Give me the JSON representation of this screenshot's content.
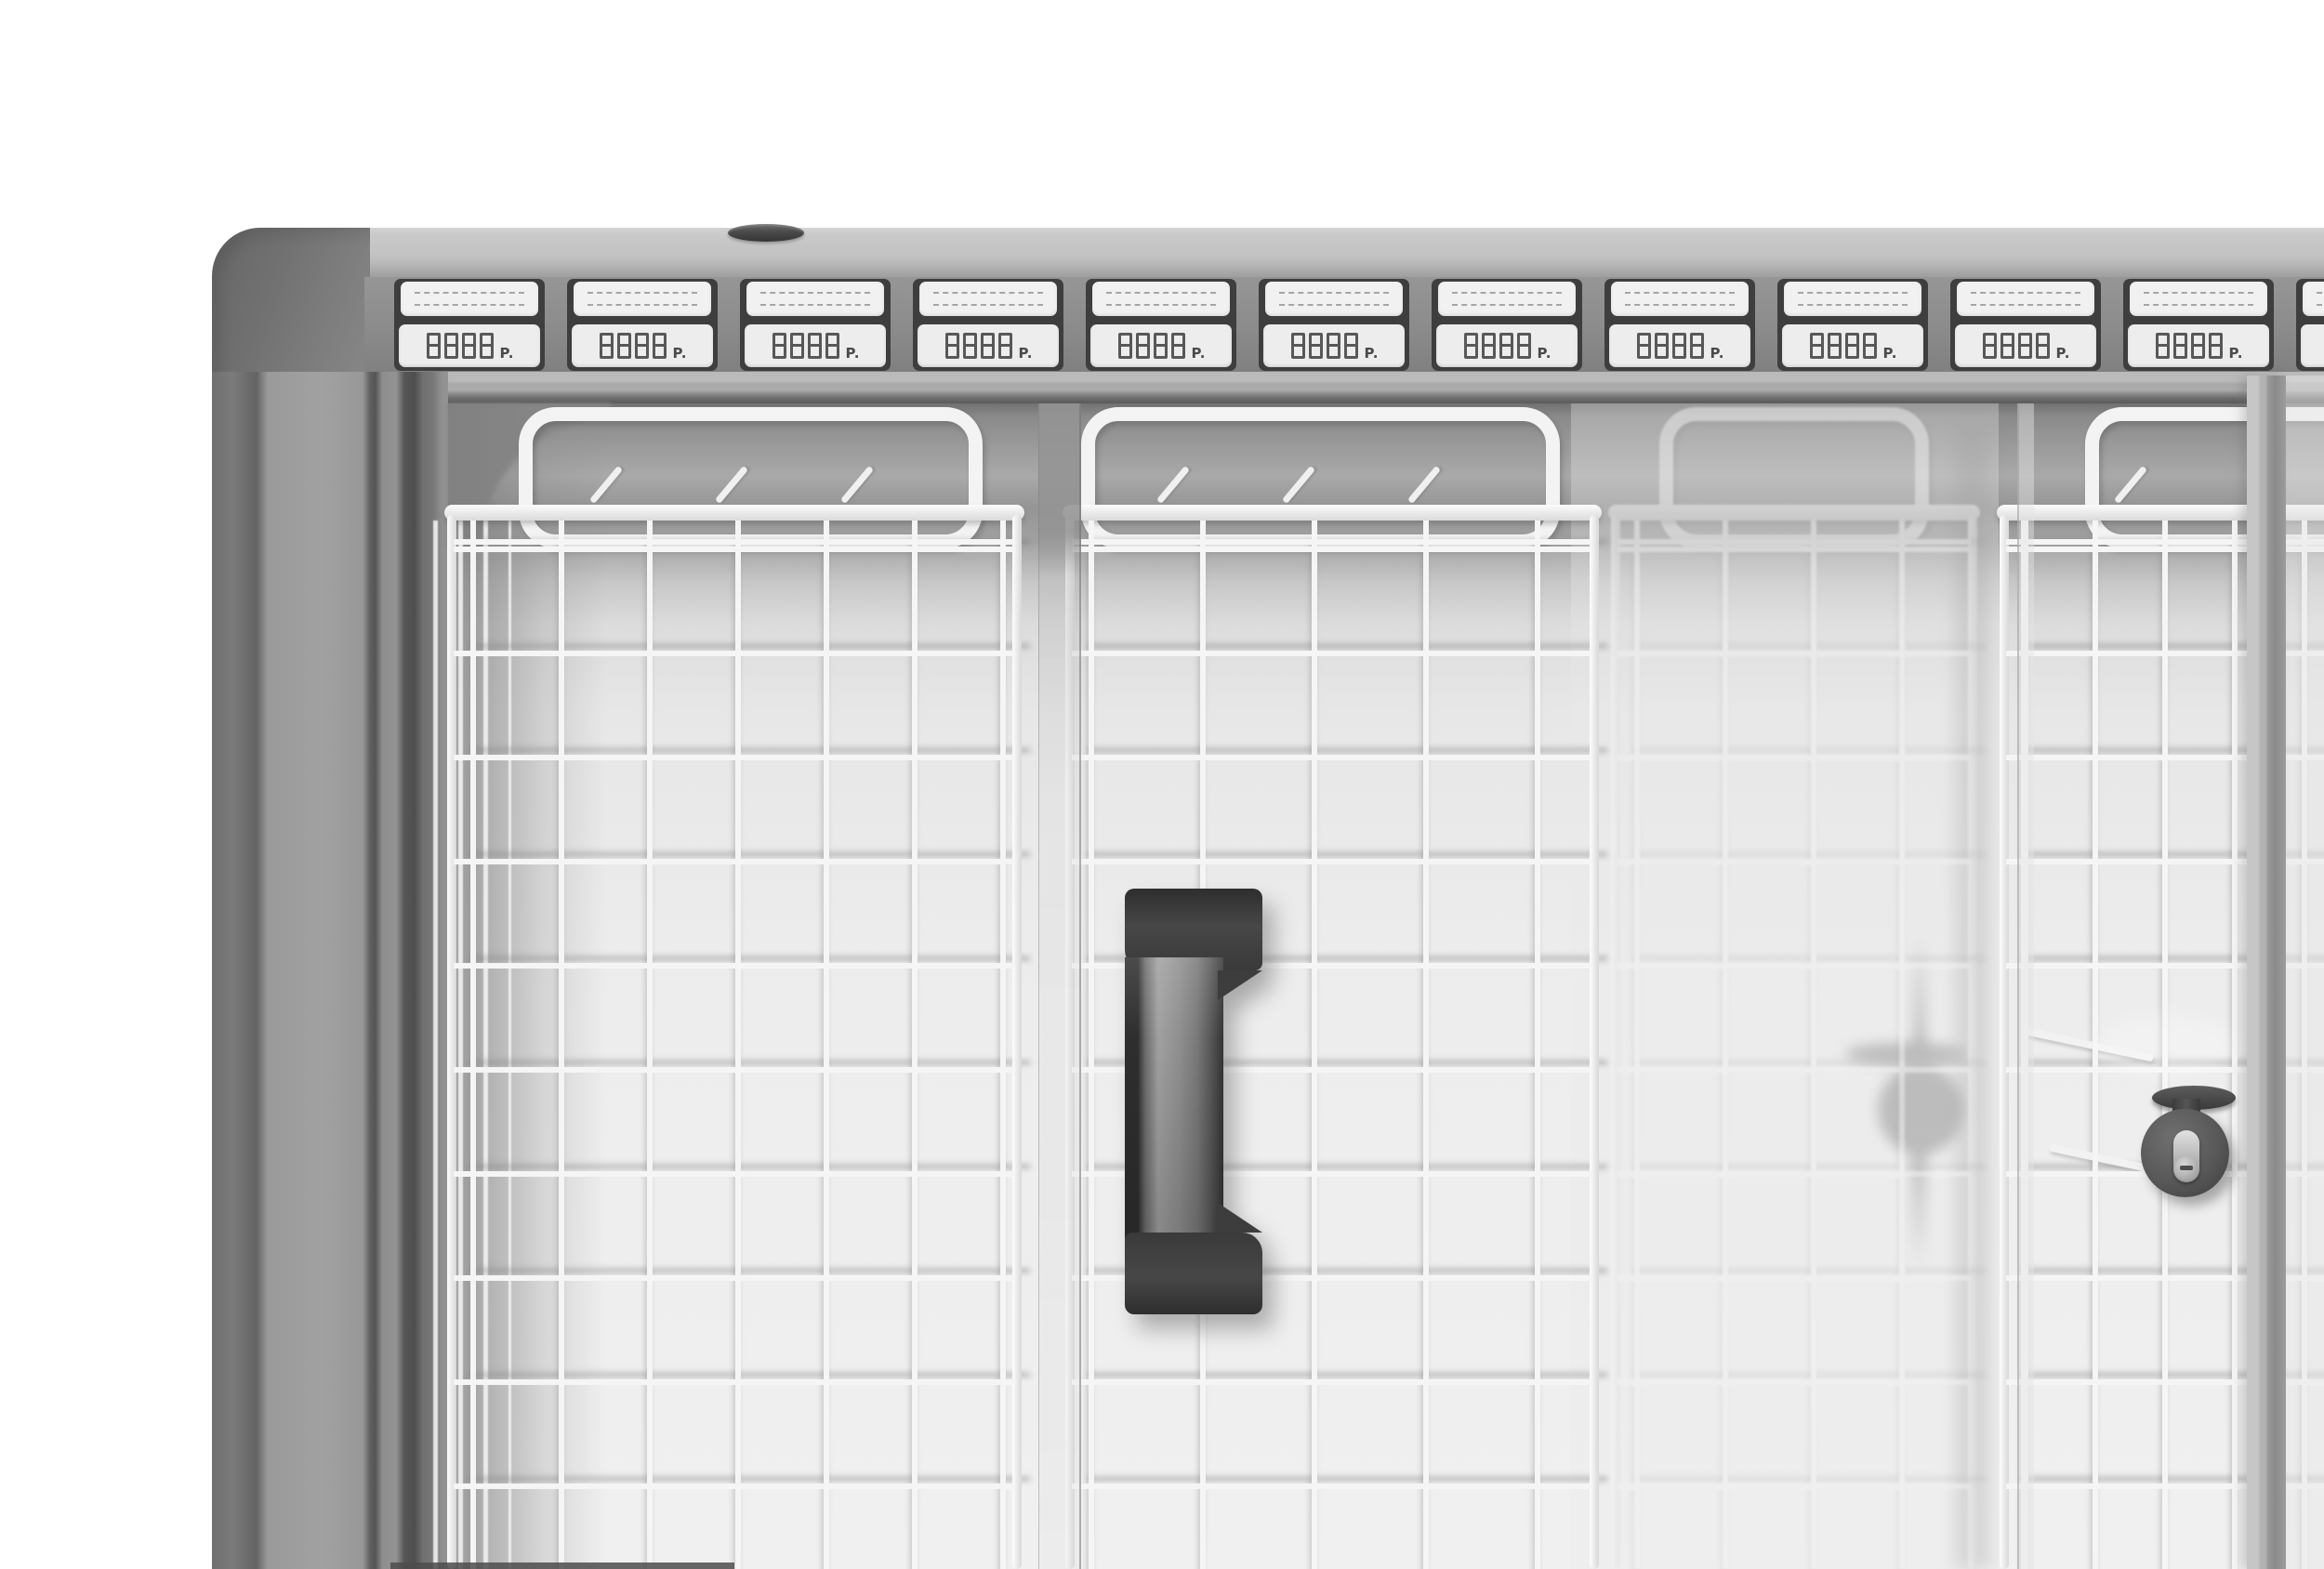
{
  "price_rail": {
    "tag_count": 12,
    "tags": [
      {
        "price": "8888",
        "currency": "P."
      },
      {
        "price": "8888",
        "currency": "P."
      },
      {
        "price": "8888",
        "currency": "P."
      },
      {
        "price": "8888",
        "currency": "P."
      },
      {
        "price": "8888",
        "currency": "P."
      },
      {
        "price": "8888",
        "currency": "P."
      },
      {
        "price": "8888",
        "currency": "P."
      },
      {
        "price": "8888",
        "currency": "P."
      },
      {
        "price": "8888",
        "currency": "P."
      },
      {
        "price": "8888",
        "currency": "P."
      },
      {
        "price": "8888",
        "currency": "P."
      },
      {
        "price": "8888",
        "currency": "P."
      }
    ]
  },
  "palette": {
    "background": "#ffffff",
    "cabinet_light_gray": "#c2c2c2",
    "cabinet_mid_gray": "#8f8f8f",
    "cabinet_dark_gray": "#565656",
    "tag_holder": "#3e3e3e",
    "tag_label_bg": "#f1f1f1",
    "tag_display_bg": "#ededed",
    "digit_color": "#585858",
    "wire_white": "#f4f4f4",
    "handle_dark": "#383838",
    "interior_bright": "#ededed"
  }
}
